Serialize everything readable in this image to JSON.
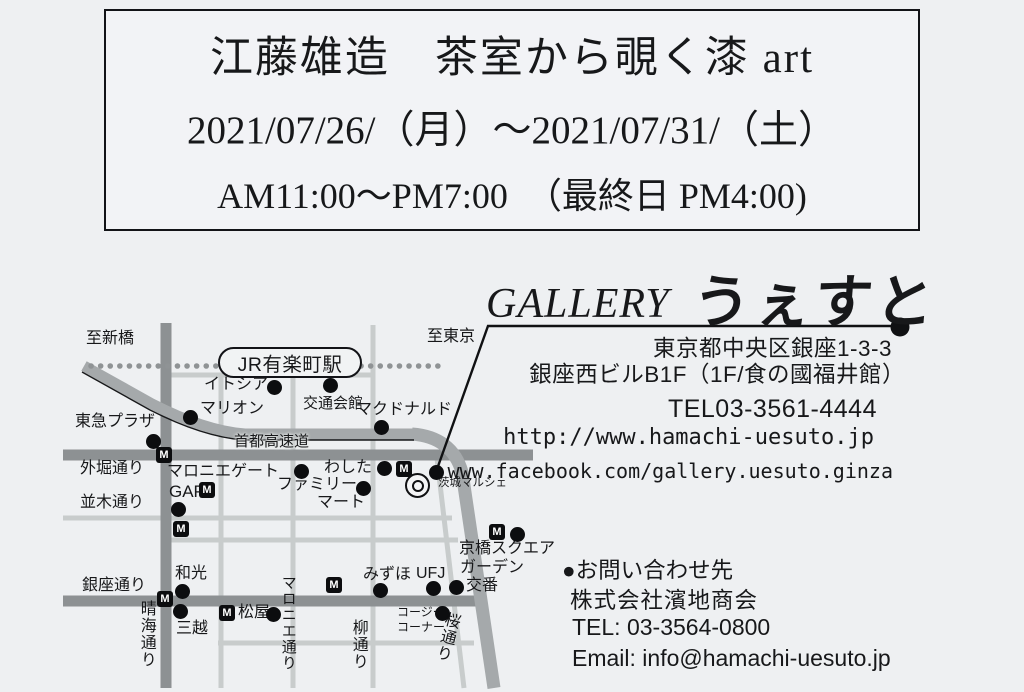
{
  "header": {
    "title": "江藤雄造　茶室から覗く漆 art",
    "dates": "2021/07/26/（月）～2021/07/31/（土）",
    "hours": "AM11:00～PM7:00　（最終日 PM4:00)"
  },
  "gallery": {
    "name_latin": "GALLERY",
    "name_kana": "うぇすと",
    "address_line1": "東京都中央区銀座1-3-3",
    "address_line2": "銀座西ビルB1F（1F/食の國福井館）",
    "tel": "TEL03-3561-4444",
    "url": "http://www.hamachi-uesuto.jp",
    "facebook": "www.facebook.com/gallery.uesuto.ginza"
  },
  "contact": {
    "heading": "●お問い合わせ先",
    "company": "株式会社濱地商会",
    "tel": "TEL: 03-3564-0800",
    "email": "Email: info@hamachi-uesuto.jp"
  },
  "map": {
    "metro_glyph": "M",
    "station": "JR有楽町駅",
    "directions": {
      "left": "至新橋",
      "right": "至東京"
    },
    "roads": {
      "expressway": "首都高速道",
      "sotobori": "外堀通り",
      "namiki": "並木通り",
      "ginza": "銀座通り",
      "harumi": "晴海通り",
      "maronie": "マロニエ通り",
      "yanagi": "柳通り",
      "sakura": "桜通り"
    },
    "landmarks": {
      "itocia": "イトシア",
      "marion": "マリオン",
      "kotsukaikan": "交通会館",
      "mcdonalds": "マクドナルド",
      "tokyuplaza": "東急プラザ",
      "maroniegate": "マロニエゲート",
      "washita": "わした",
      "ibaraki": "茨城マルシェ",
      "family1": "ファミリー",
      "family2": "マート",
      "gap": "GAP",
      "kyobashi1": "京橋スクエア",
      "kyobashi2": "ガーデン",
      "koban": "交番",
      "wako": "和光",
      "mizuho": "みずほ",
      "ufj": "UFJ",
      "mitsukoshi": "三越",
      "matsuya": "松屋",
      "cozy1": "コージー",
      "cozy2": "コーナー"
    }
  },
  "colors": {
    "background": "#eef0f2",
    "ink": "#17181a",
    "road_major": "#8d9193",
    "road_minor": "#c8cccc",
    "expressway": "#a5a9ab",
    "railway_dots": "#8f9395"
  }
}
